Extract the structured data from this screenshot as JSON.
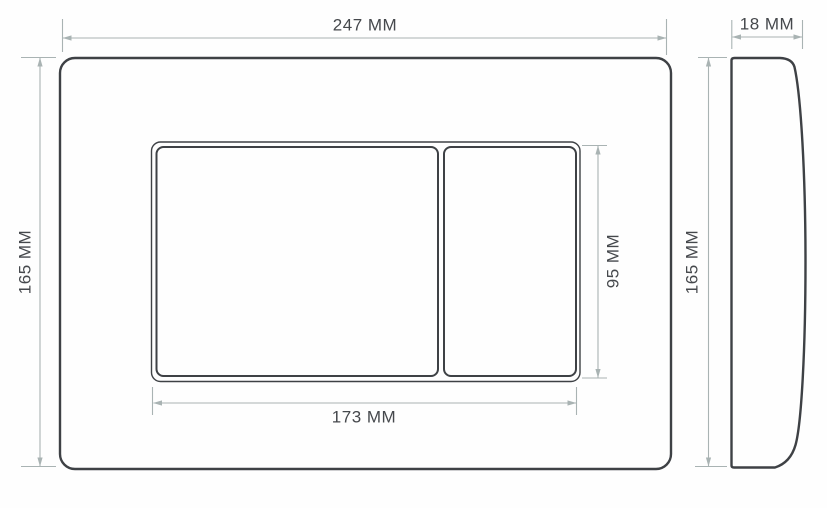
{
  "drawing": {
    "front_view": {
      "width_label": "247 MM",
      "height_label": "165 MM",
      "buttons_width_label": "173 MM",
      "small_button_height_label": "95 MM"
    },
    "side_view": {
      "depth_label": "18 MM",
      "height_label": "165 MM"
    }
  },
  "colors": {
    "background": "#fefefe",
    "line": "#3e4145",
    "dimension": "#a9b3b3",
    "text": "#45484c"
  }
}
